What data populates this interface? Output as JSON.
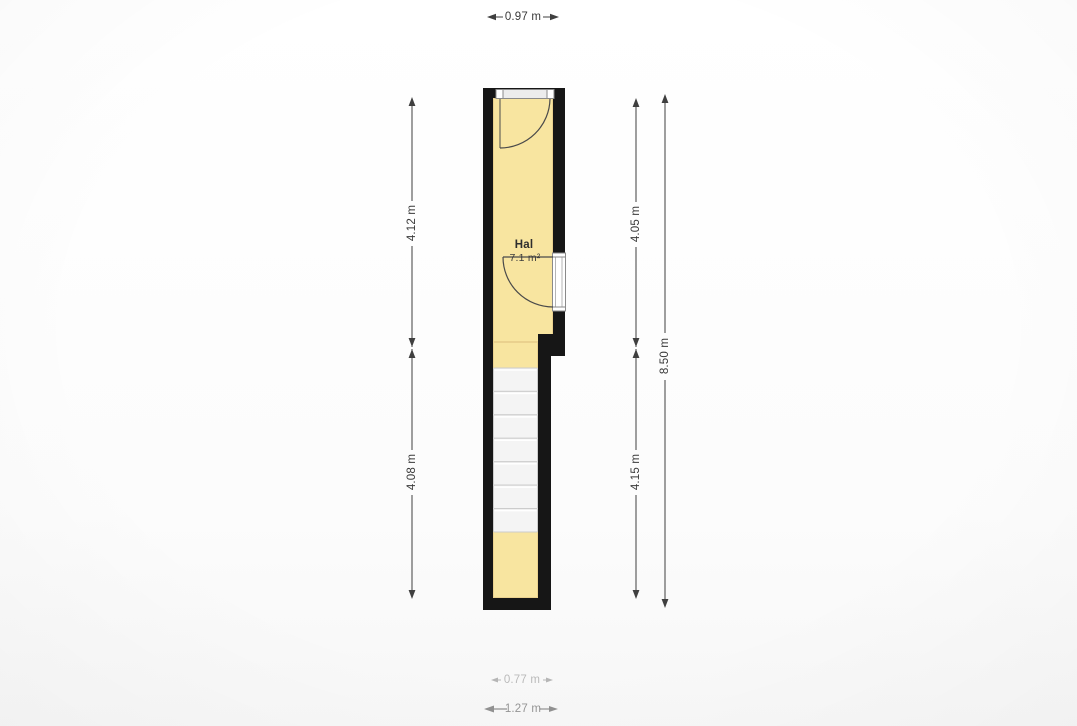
{
  "floorplan": {
    "room": {
      "name": "Hal",
      "area": "7.1 m²"
    },
    "dimensions": {
      "top_width": "0.97 m",
      "left_upper": "4.12 m",
      "left_lower": "4.08 m",
      "right_upper": "4.05 m",
      "right_lower": "4.15 m",
      "right_total": "8.50 m",
      "bottom_inner": "0.77 m",
      "bottom_outer": "1.27 m"
    },
    "stairs": {
      "steps": 7
    },
    "colors": {
      "floor": "#F8E5A0",
      "floor_edge": "#EAD18E",
      "wall": "#161616",
      "stairs_fill": "#F4F4F4",
      "stairs_line": "#CCCCCC",
      "door_line": "#4A4A4A",
      "dimension_line": "#3F3F3F",
      "dimension_text": "#3A3A3A"
    }
  }
}
